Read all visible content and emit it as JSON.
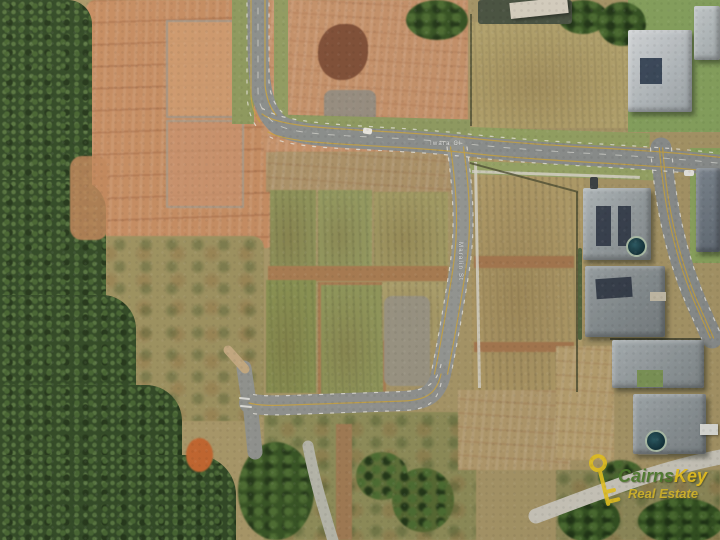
{
  "image": {
    "kind": "aerial-satellite-photograph",
    "subject": "Residential land subdivision under development beside rainforest",
    "width_px": 720,
    "height_px": 540
  },
  "watermark": {
    "brand_first": "Cairns",
    "brand_second": "Key",
    "tagline": "Real Estate",
    "icon": "key-icon",
    "color_first": "#4f7d2b",
    "color_second": "#edc41d",
    "color_tagline": "#d9b92a"
  },
  "street_labels": [
    {
      "id": "main-road-label",
      "text": "Iwara Cl",
      "orientation": "horizontal"
    },
    {
      "id": "loop-road-label",
      "text": "Maralin St",
      "orientation": "vertical"
    }
  ],
  "scene": {
    "terrain": [
      "dense rainforest strip (west and south-west)",
      "graded orange earth terraces (north-west)",
      "fenced grass paddock lots (centre)",
      "suburban houses with grey roofs (east)"
    ],
    "roads": [
      "sealed loop road with yellow edge lines and hammerhead turnaround",
      "east side street with double yellow centre line",
      "light unsealed concrete road (south-east)",
      "concrete drain channel (south)"
    ],
    "houses_visible": 8,
    "pools_visible": 2,
    "solar_arrays_visible": 3,
    "vehicles": [
      "white car on main road",
      "white car near east street",
      "dark car in driveway",
      "white trailer on right edge"
    ]
  },
  "palette": {
    "asphalt": "#8a8d8b",
    "new_concrete_road": "#cbc7ba",
    "rainforest": "#2b4420",
    "graded_earth": "#c58a5e",
    "paddock_green": "#8f9458",
    "roof_grey": "#9aa1a3",
    "road_line_yellow": "#c9a23c"
  }
}
